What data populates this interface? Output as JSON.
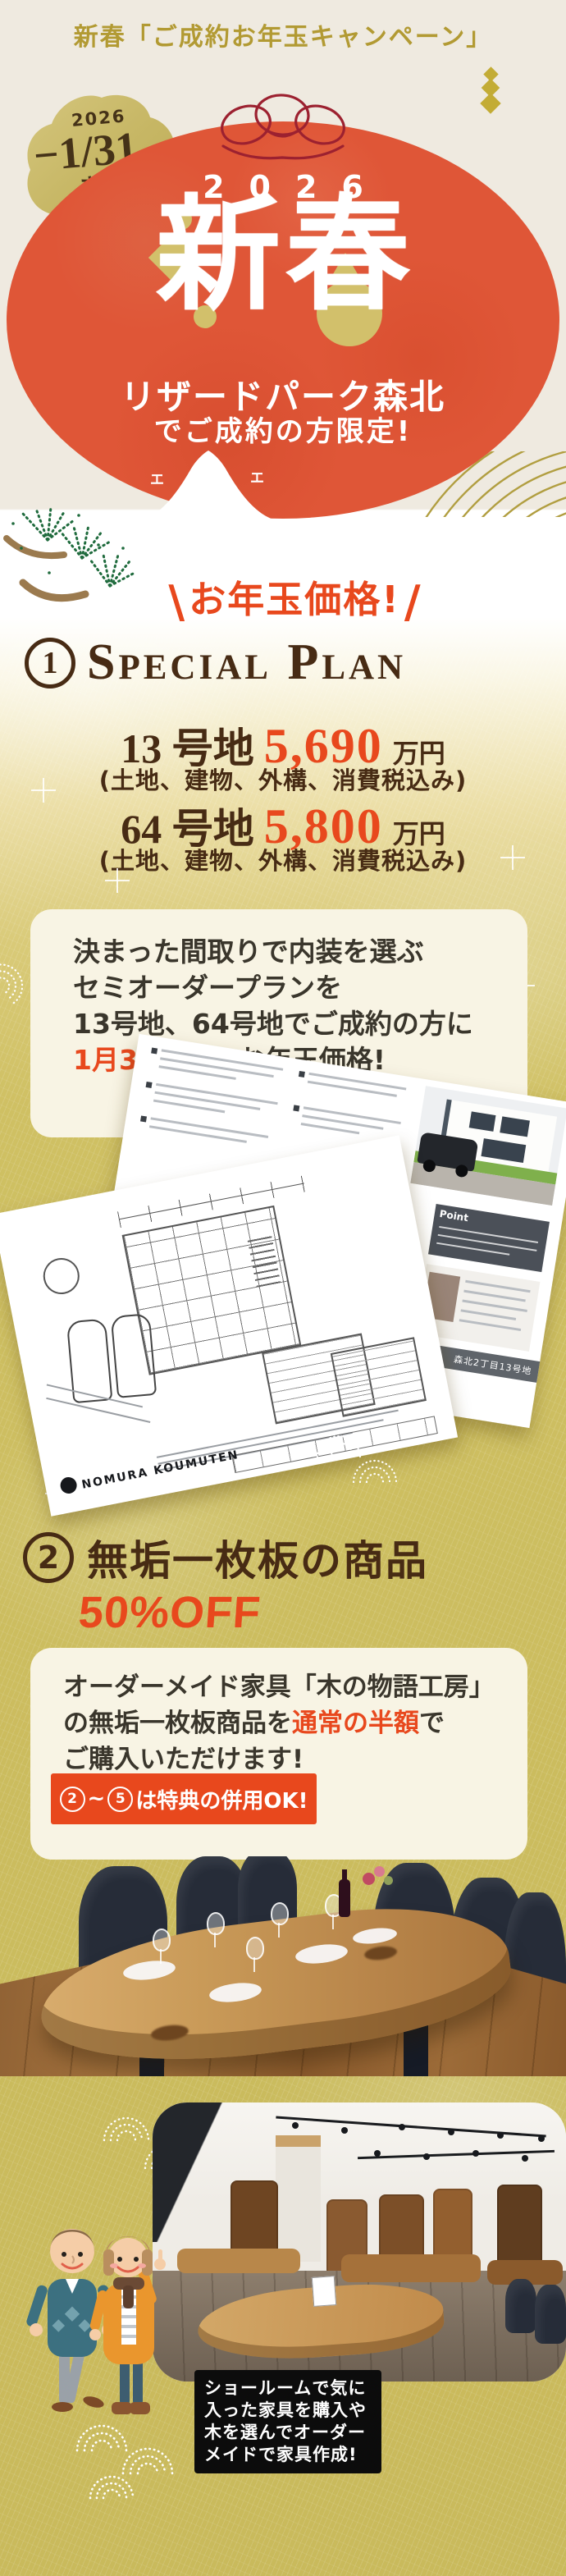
{
  "colors": {
    "accent_red": "#e8481d",
    "brown": "#472b14",
    "gold_bg": "#cfc063",
    "header_gold": "#b29a33",
    "hero_red": "#df5637",
    "cream_card": "#f8f4e4"
  },
  "header": {
    "title": "新春「ご成約お年玉キャンペーン」"
  },
  "hero": {
    "badge": {
      "year": "2026",
      "date": "−1/31",
      "day": "FRI",
      "until": "まで"
    },
    "year": "2026",
    "title": "新春",
    "subtitle1": "リザードパーク森北",
    "subtitle2": "でご成約の方限定!",
    "fuji_mark": "エ"
  },
  "callout": {
    "slash_left": "\\",
    "text": "お年玉価格!",
    "slash_right": "/"
  },
  "special_plan": {
    "number": "1",
    "title": "Special Plan",
    "lots": [
      {
        "name": "13 号地",
        "price": "5,690",
        "unit": "万円",
        "note": "(土地、建物、外構、消費税込み)"
      },
      {
        "name": "64 号地",
        "price": "5,800",
        "unit": "万円",
        "note": "(土地、建物、外構、消費税込み)"
      }
    ],
    "card": {
      "line1": "決まった間取りで内装を選ぶ",
      "line2": "セミオーダープランを",
      "line3": "13号地、64号地でご成約の方に",
      "line4_highlight": "1月31日まで",
      "line4_rest": "お年玉価格!"
    }
  },
  "plan_documents": {
    "brand_a": "NOMURA",
    "point_label": "Point",
    "footer_label": "森北2丁目13号地",
    "brand_b": "NOMURA KOUMUTEN"
  },
  "offer2": {
    "number": "2",
    "title": "無垢一枚板の商品",
    "discount": "50%OFF",
    "card": {
      "line1": "オーダーメイド家具「木の物語工房」",
      "line2_pre": "の無垢一枚板商品を",
      "line2_highlight": "通常の半額",
      "line2_post": "で",
      "line3": "ご購入いただけます!"
    },
    "cta": {
      "from": "2",
      "tilde": "~",
      "to": "5",
      "text": "は特典の併用OK!"
    }
  },
  "showroom": {
    "caption": [
      "ショールームで気に",
      "入った家具を購入や",
      "木を選んでオーダー",
      "メイドで家具作成!"
    ]
  }
}
